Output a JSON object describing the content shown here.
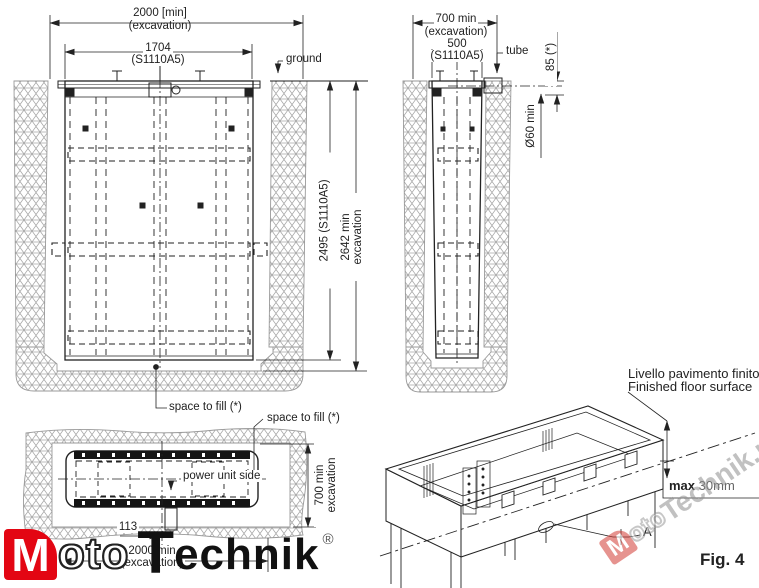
{
  "drawing": {
    "front_view": {
      "dim_excavation_width": "2000  [min]",
      "dim_excavation_width_sub": "(excavation)",
      "dim_frame_width": "1704",
      "dim_frame_width_sub": "(S1110A5)",
      "ground_label": "ground",
      "dim_frame_depth": "2495 (S1110A5)",
      "dim_excavation_depth_line1": "2642  min",
      "dim_excavation_depth_line2": "excavation",
      "space_to_fill_label": "space to fill (*)"
    },
    "side_view": {
      "dim_excavation_width": "700  min",
      "dim_excavation_width_sub": "(excavation)",
      "dim_frame_width": "500",
      "dim_frame_width_sub": "(S1110A5)",
      "tube_label": "tube",
      "dim_tube_depth": "85  (*)",
      "dim_tube_diameter": "Ø60  min"
    },
    "top_view": {
      "space_to_fill_label": "space to fill (*)",
      "power_unit_label": "power unit side",
      "dim_excavation_height_line1": "700  min",
      "dim_excavation_height_line2": "excavation",
      "dim_tube_offset": "113",
      "dim_excavation_width": "2000  min",
      "dim_excavation_width_sub": "(excavation)"
    },
    "iso_view": {
      "floor_label_it": "Livello pavimento finito",
      "floor_label_en": "Finished floor surface",
      "max_label": "max",
      "max_value": "30mm",
      "detail_label": "A",
      "figure_label": "Fig. 4"
    }
  },
  "logo": {
    "m": "M",
    "oto": "oto",
    "t": "T",
    "echnik": "echnik",
    "reg": "®"
  },
  "watermark": {
    "m": "M",
    "oto": "oto",
    "rest": "Technik.pl"
  },
  "colors": {
    "line": "#222222",
    "soil_hatch": "#a3a3a3",
    "logo_red": "#e30613",
    "watermark_gray": "#8f8f8f"
  }
}
